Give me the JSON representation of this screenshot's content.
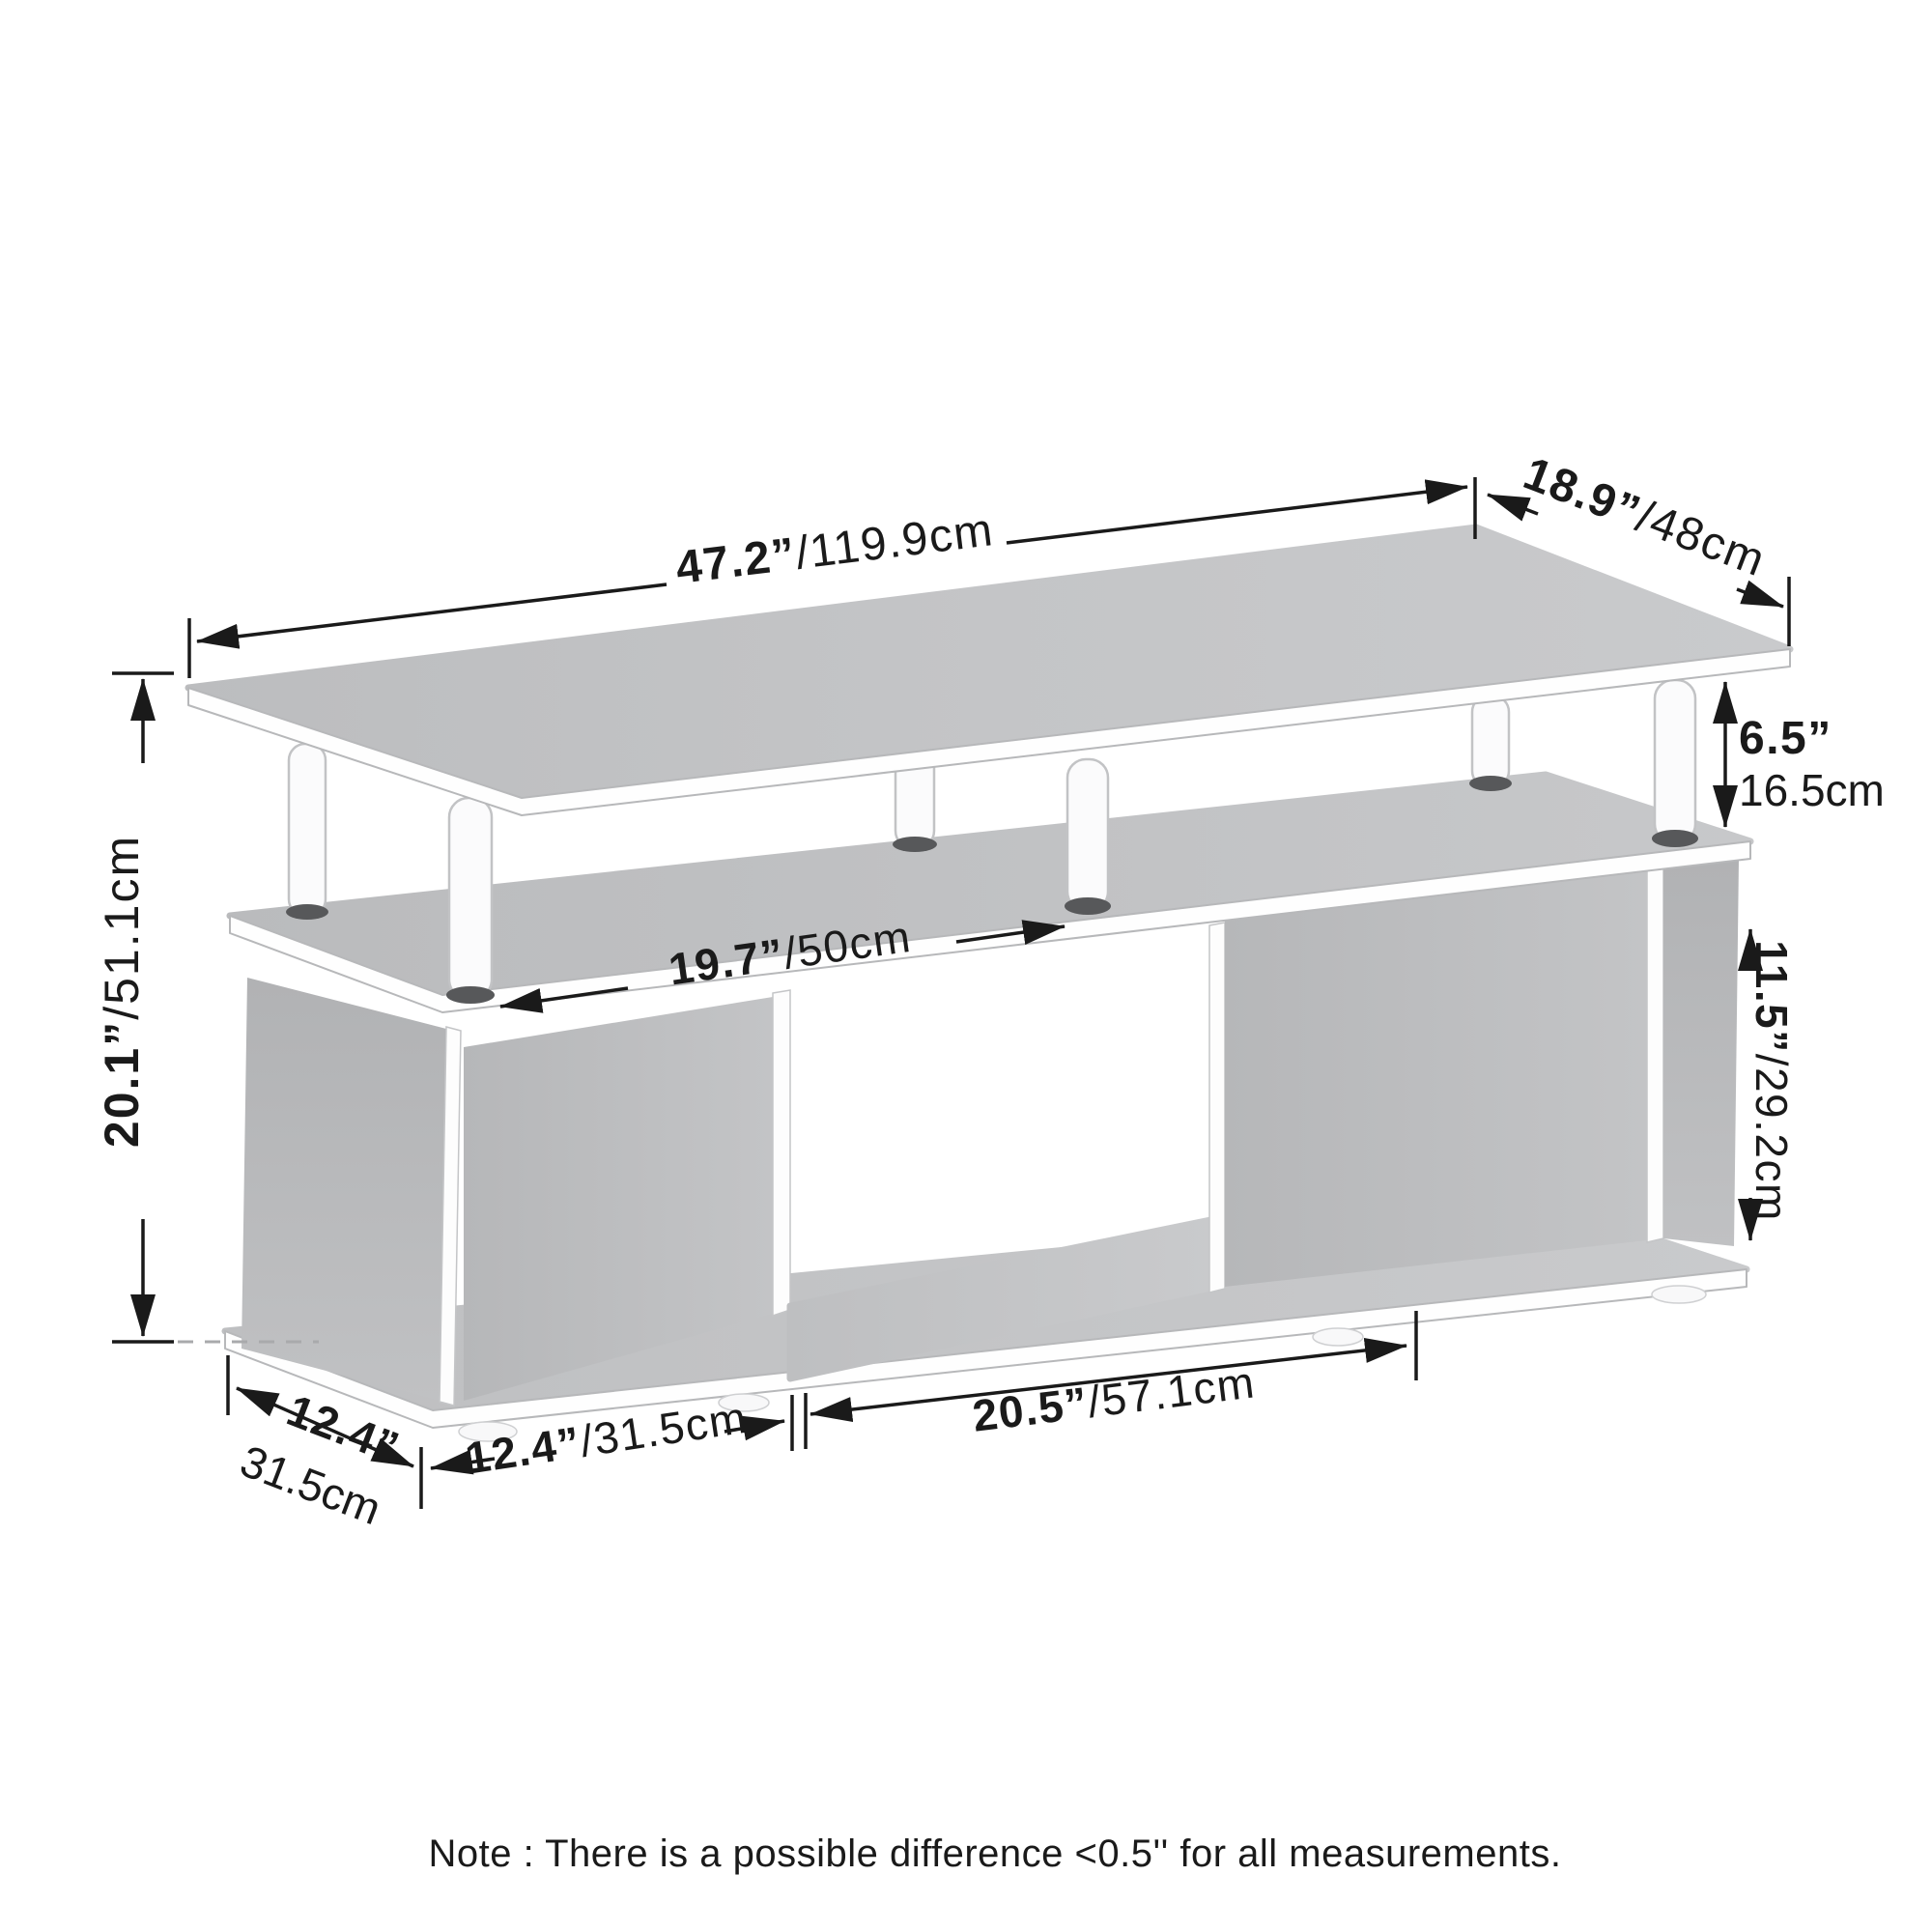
{
  "diagram": {
    "type": "furniture-dimension-drawing",
    "product": "3-shelf TV stand / coffee table with elevated top board, support posts and three lower compartments",
    "dimensions": {
      "top_length": {
        "in": "47.2”",
        "cm": "/119.9cm"
      },
      "top_depth": {
        "in": "18.9”",
        "cm": "/48cm"
      },
      "riser_height": {
        "in": "6.5”",
        "cm": "16.5cm"
      },
      "cabinet_height": {
        "in": "11.5”",
        "cm": "/29.2cm"
      },
      "total_height": {
        "in": "20.1”",
        "cm": "/51.1cm"
      },
      "post_spacing": {
        "in": "19.7”",
        "cm": "/50cm"
      },
      "middle_opening": {
        "in": "20.5”",
        "cm": "/57.1cm"
      },
      "side_compartment": {
        "in": "12.4”",
        "cm": "/31.5cm"
      },
      "base_depth": {
        "in": "12.4”",
        "cm": "31.5cm"
      }
    },
    "note": "Note : There is a possible difference <0.5'' for all measurements.",
    "colors": {
      "surface_gray": "#c3c4c6",
      "panel_gray": "#b5b6b8",
      "edge_white": "#fefefe",
      "dimension_black": "#1a1a1a",
      "leg_cap_gray": "#57585a",
      "dashed_gray": "#a9aaac",
      "background": "#ffffff"
    }
  }
}
